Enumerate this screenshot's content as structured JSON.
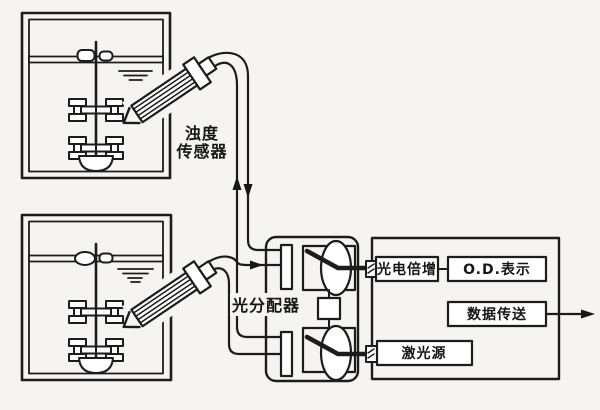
{
  "diagram": {
    "labels": {
      "turbidity_sensor_line1": "浊度",
      "turbidity_sensor_line2": "传感器",
      "light_distributor": "光分配器",
      "photomultiplier": "光电倍增",
      "od_display": "O.D.表示",
      "data_transmission": "数据传送",
      "laser_source": "激光源"
    },
    "colors": {
      "line": "#1c1c1c",
      "background": "#f5f4f1",
      "shape_fill": "#ffffff"
    }
  }
}
